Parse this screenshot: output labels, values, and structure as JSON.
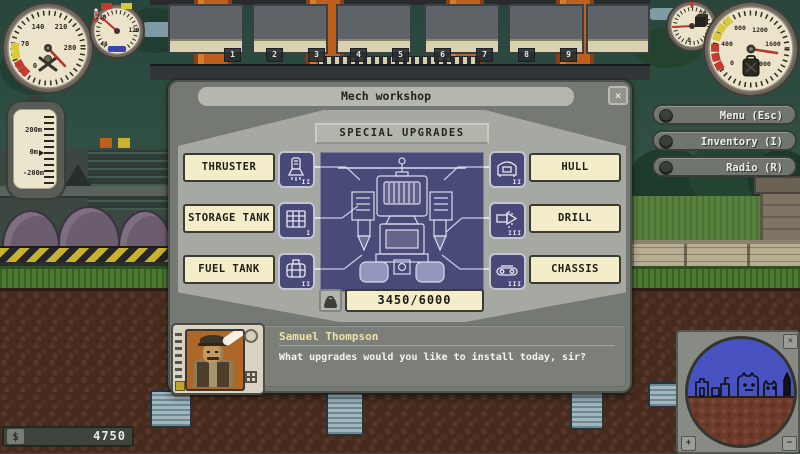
{
  "palette": {
    "cream": "#f3edca",
    "navy": "#4a4a78",
    "dialog_gray": "#747973",
    "panel_light": "#a6a9a1",
    "title_bar": "#b4b7ae",
    "name_yellow": "#e9e3ad",
    "minimap_sky": "#4952c1",
    "minimap_ground": "#6d3b2b"
  },
  "window": {
    "title": "Mech workshop",
    "close_glyph": "✕"
  },
  "workshop": {
    "header": "SPECIAL UPGRADES",
    "upgrades": [
      {
        "label": "THRUSTER",
        "level": "II",
        "icon": "thruster-icon"
      },
      {
        "label": "STORAGE TANK",
        "level": "I",
        "icon": "storage-tank-icon"
      },
      {
        "label": "FUEL TANK",
        "level": "II",
        "icon": "fuel-tank-icon"
      },
      {
        "label": "HULL",
        "level": "II",
        "icon": "hull-icon"
      },
      {
        "label": "DRILL",
        "level": "III",
        "icon": "drill-icon"
      },
      {
        "label": "CHASSIS",
        "level": "III",
        "icon": "chassis-icon"
      }
    ],
    "weight_total": "3450/6000"
  },
  "speech": {
    "name": "Samuel Thompson",
    "text": "What upgrades would you like to install today, sir?"
  },
  "hud": {
    "menu_buttons": [
      {
        "label": "Menu (Esc)"
      },
      {
        "label": "Inventory (I)"
      },
      {
        "label": "Radio (R)"
      }
    ],
    "money": {
      "symbol": "$",
      "value": "4750"
    },
    "altimeter": {
      "ticks": [
        "200m",
        "0m",
        "-200m"
      ]
    },
    "gauges": {
      "speed": {
        "ticks": [
          "0",
          "70",
          "140",
          "210",
          "280"
        ]
      },
      "temperature": {
        "ticks": [
          "220",
          "120",
          "40"
        ]
      },
      "cargo": {
        "ticks": [
          "20",
          "0"
        ]
      },
      "fuel": {
        "ticks": [
          "0",
          "400",
          "800",
          "1200",
          "1600",
          "2000"
        ]
      }
    },
    "minimap": {
      "close_glyph": "✕",
      "zoom_in": "+",
      "zoom_out": "−"
    }
  },
  "background": {
    "bay_numbers": [
      "1",
      "2",
      "3",
      "4",
      "5",
      "6",
      "7",
      "8",
      "9"
    ]
  }
}
